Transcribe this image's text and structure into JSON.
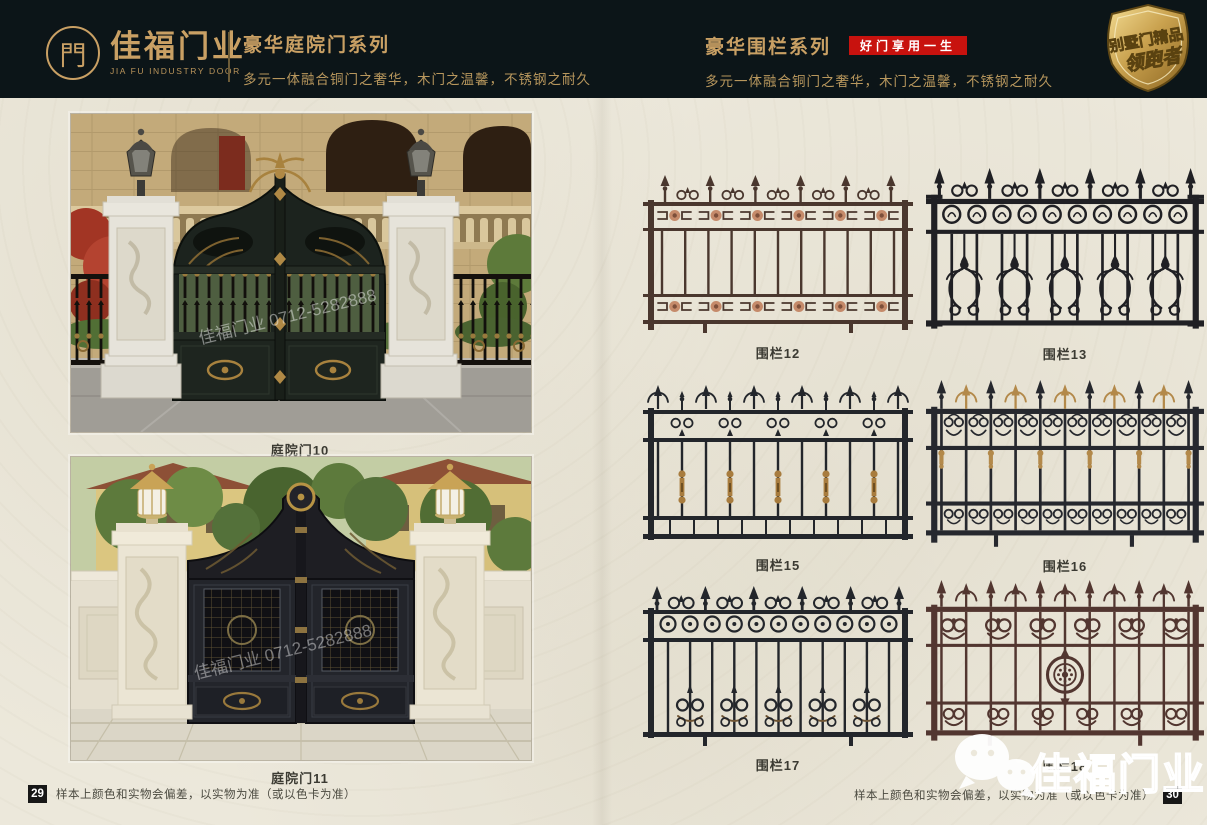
{
  "header": {
    "logo": {
      "symbol": "門",
      "name_cn": "佳福门业",
      "name_en": "JIA FU INDUSTRY DOOR"
    },
    "left_series": {
      "title": "豪华庭院门系列",
      "subtitle": "多元一体融合铜门之奢华，木门之温馨，不锈钢之耐久"
    },
    "right_series": {
      "title": "豪华围栏系列",
      "badge": "好门享用一生",
      "subtitle": "多元一体融合铜门之奢华，木门之温馨，不锈钢之耐久"
    },
    "corner_badge": {
      "line1": "别墅门精品",
      "line2": "领跑者"
    }
  },
  "gates": [
    {
      "caption": "庭院门10"
    },
    {
      "caption": "庭院门11"
    }
  ],
  "fences": [
    {
      "caption": "围栏12",
      "variant": "v12",
      "color": "#4a372e",
      "accent": "#c58a6a"
    },
    {
      "caption": "围栏13",
      "variant": "v13",
      "color": "#202024",
      "accent": "#202024"
    },
    {
      "caption": "围栏15",
      "variant": "v15",
      "color": "#23262b",
      "accent": "#a87c3e"
    },
    {
      "caption": "围栏16",
      "variant": "v16",
      "color": "#26282e",
      "accent": "#b3894a"
    },
    {
      "caption": "围栏17",
      "variant": "v17",
      "color": "#23262b",
      "accent": "#6e5433"
    },
    {
      "caption": "围栏18",
      "variant": "v18",
      "color": "#523630",
      "accent": "#523630"
    }
  ],
  "footer": {
    "left_page_number": "29",
    "right_page_number": "30",
    "note": "样本上颜色和实物会偏差，以实物为准（或以色卡为准）"
  },
  "watermark": {
    "brand": "佳福门业"
  },
  "photo_watermark": "佳福门业 0712-5282888",
  "colors": {
    "header_bg": "#0c1518",
    "gold": "#c9a064",
    "badge_red": "#c8120e",
    "page_bg": "#ece8db"
  }
}
